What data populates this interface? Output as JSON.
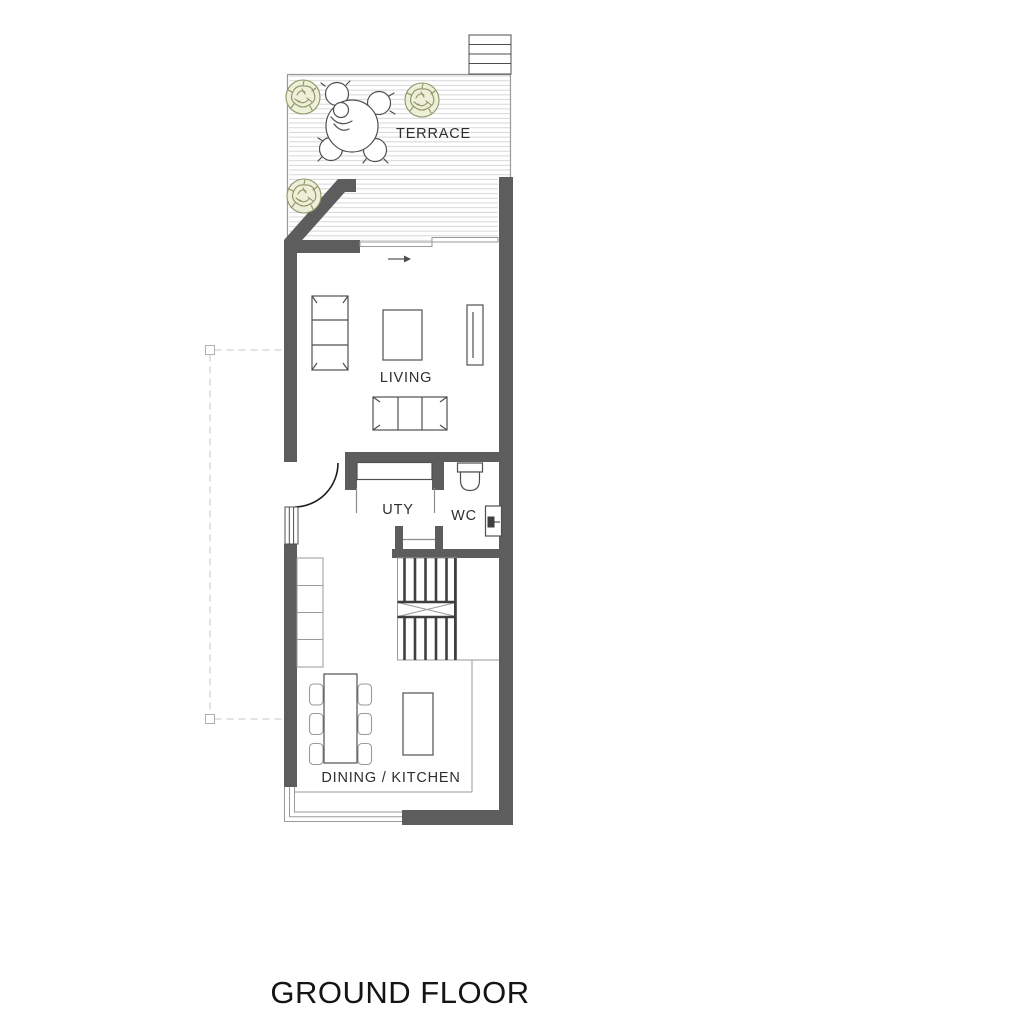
{
  "title": "GROUND FLOOR",
  "rooms": {
    "terrace": "TERRACE",
    "living": "LIVING",
    "utility": "UTY",
    "wc": "WC",
    "dining_kitchen": "DINING / KITCHEN"
  },
  "colors": {
    "wall": "#5d5d5d",
    "furniture_line": "#4f4f4f",
    "light_line": "#9a9a9a",
    "hatch": "#d2d2d2",
    "dashed": "#c4c4c4",
    "tree_stroke": "#8d9464",
    "tree_fill": "#edefd8",
    "stair_line": "#3f3f3f",
    "label_text": "#2e2e2e",
    "title_text": "#141414"
  }
}
